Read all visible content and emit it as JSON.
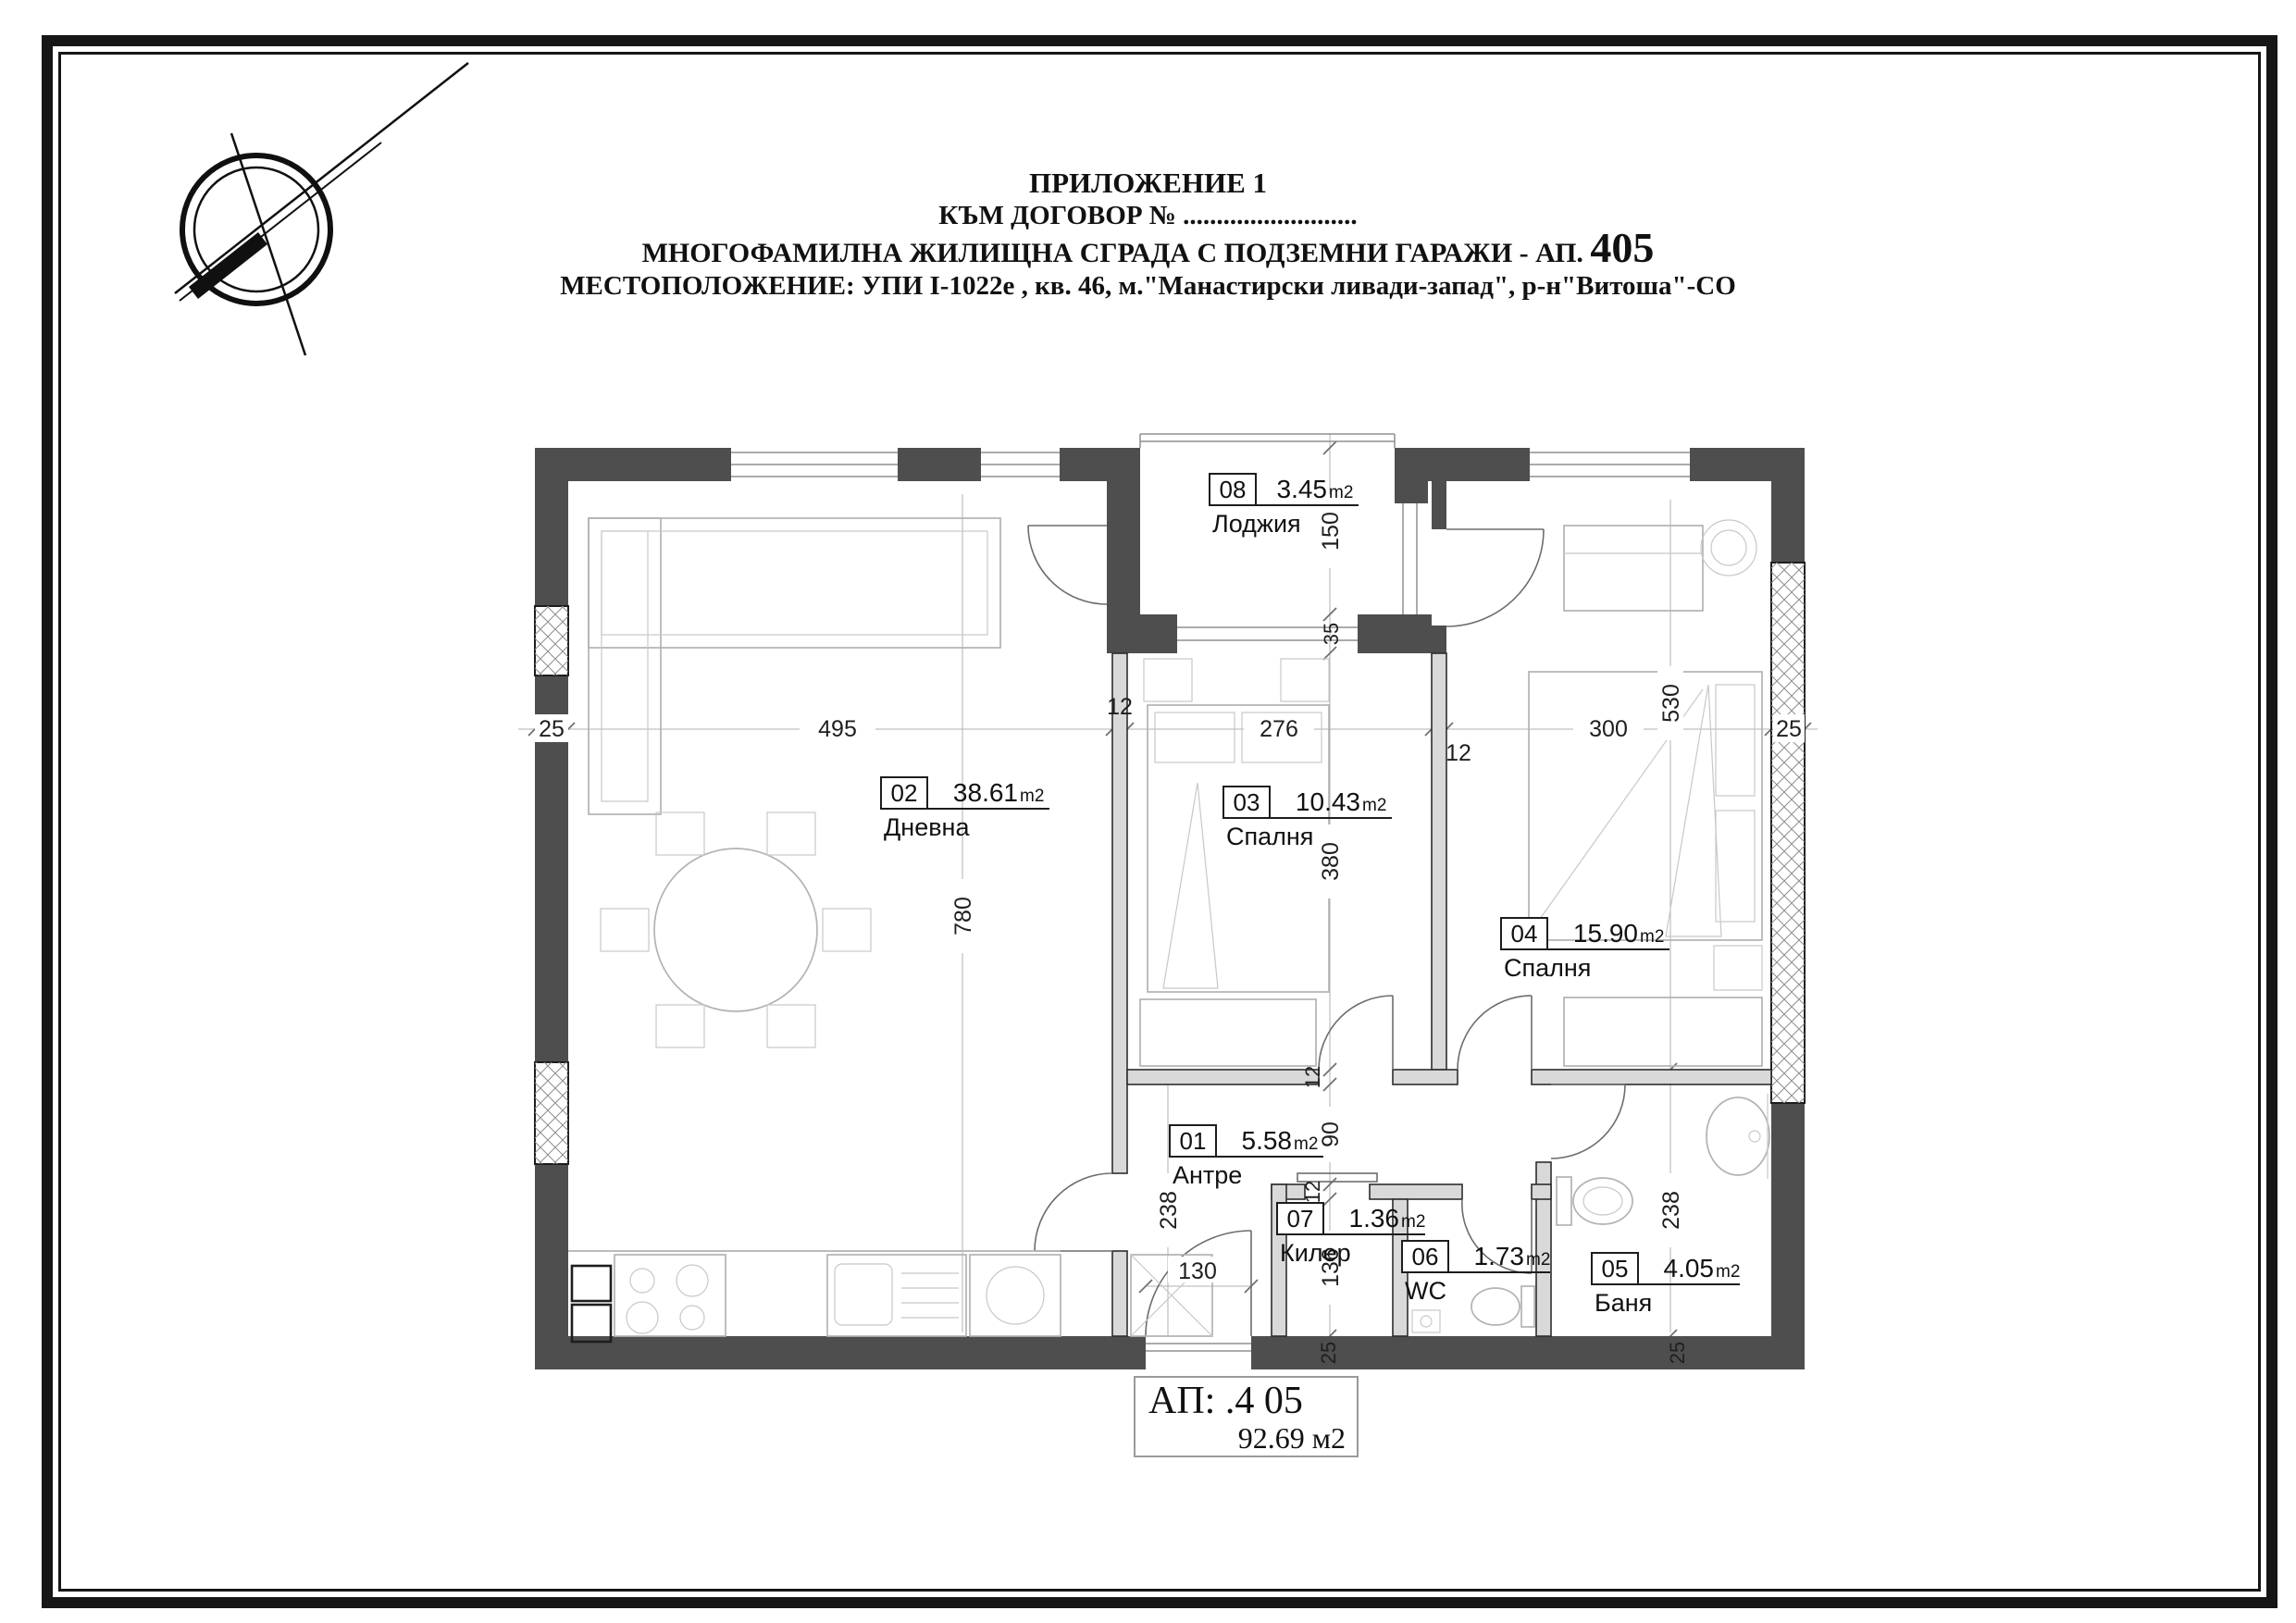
{
  "header": {
    "line1": "ПРИЛОЖЕНИЕ 1",
    "line2": "КЪМ ДОГОВОР № ..........................",
    "line3_text": "МНОГОФАМИЛНА ЖИЛИЩНА СГРАДА С ПОДЗЕМНИ ГАРАЖИ - АП.",
    "line3_number": "405",
    "line4": "МЕСТОПОЛОЖЕНИЕ: УПИ I-1022е , кв. 46, м.\"Манастирски ливади-запад\", р-н\"Витоша\"-СО"
  },
  "rooms": [
    {
      "number": "01",
      "area": "5.58",
      "unit": "m2",
      "name": "Антре"
    },
    {
      "number": "02",
      "area": "38.61",
      "unit": "m2",
      "name": "Дневна"
    },
    {
      "number": "03",
      "area": "10.43",
      "unit": "m2",
      "name": "Спалня"
    },
    {
      "number": "04",
      "area": "15.90",
      "unit": "m2",
      "name": "Спалня"
    },
    {
      "number": "05",
      "area": "4.05",
      "unit": "m2",
      "name": "Баня"
    },
    {
      "number": "06",
      "area": "1.73",
      "unit": "m2",
      "name": "WC"
    },
    {
      "number": "07",
      "area": "1.36",
      "unit": "m2",
      "name": "Килер"
    },
    {
      "number": "08",
      "area": "3.45",
      "unit": "m2",
      "name": "Лоджия"
    }
  ],
  "apartment": {
    "line1": "АП:  .4 05",
    "area": "92.69",
    "unit": "м2"
  },
  "dims": {
    "wall_left": "25",
    "living_width": "495",
    "partition_left": "12",
    "bedroom3_width": "276",
    "partition_right": "12",
    "bedroom4_width": "300",
    "wall_right": "25",
    "loggia_depth": "150",
    "loggia_wall": "35",
    "bedroom3_depth": "380",
    "corridor_top_wall": "12",
    "corridor_width": "90",
    "corridor_bottom_wall": "12",
    "storage_depth": "136",
    "living_depth": "780",
    "hall_depth": "238",
    "bedroom4_depth": "530",
    "bath_depth": "238",
    "entry_door": "130",
    "bottom_wall_a": "25",
    "bottom_wall_b": "25"
  }
}
